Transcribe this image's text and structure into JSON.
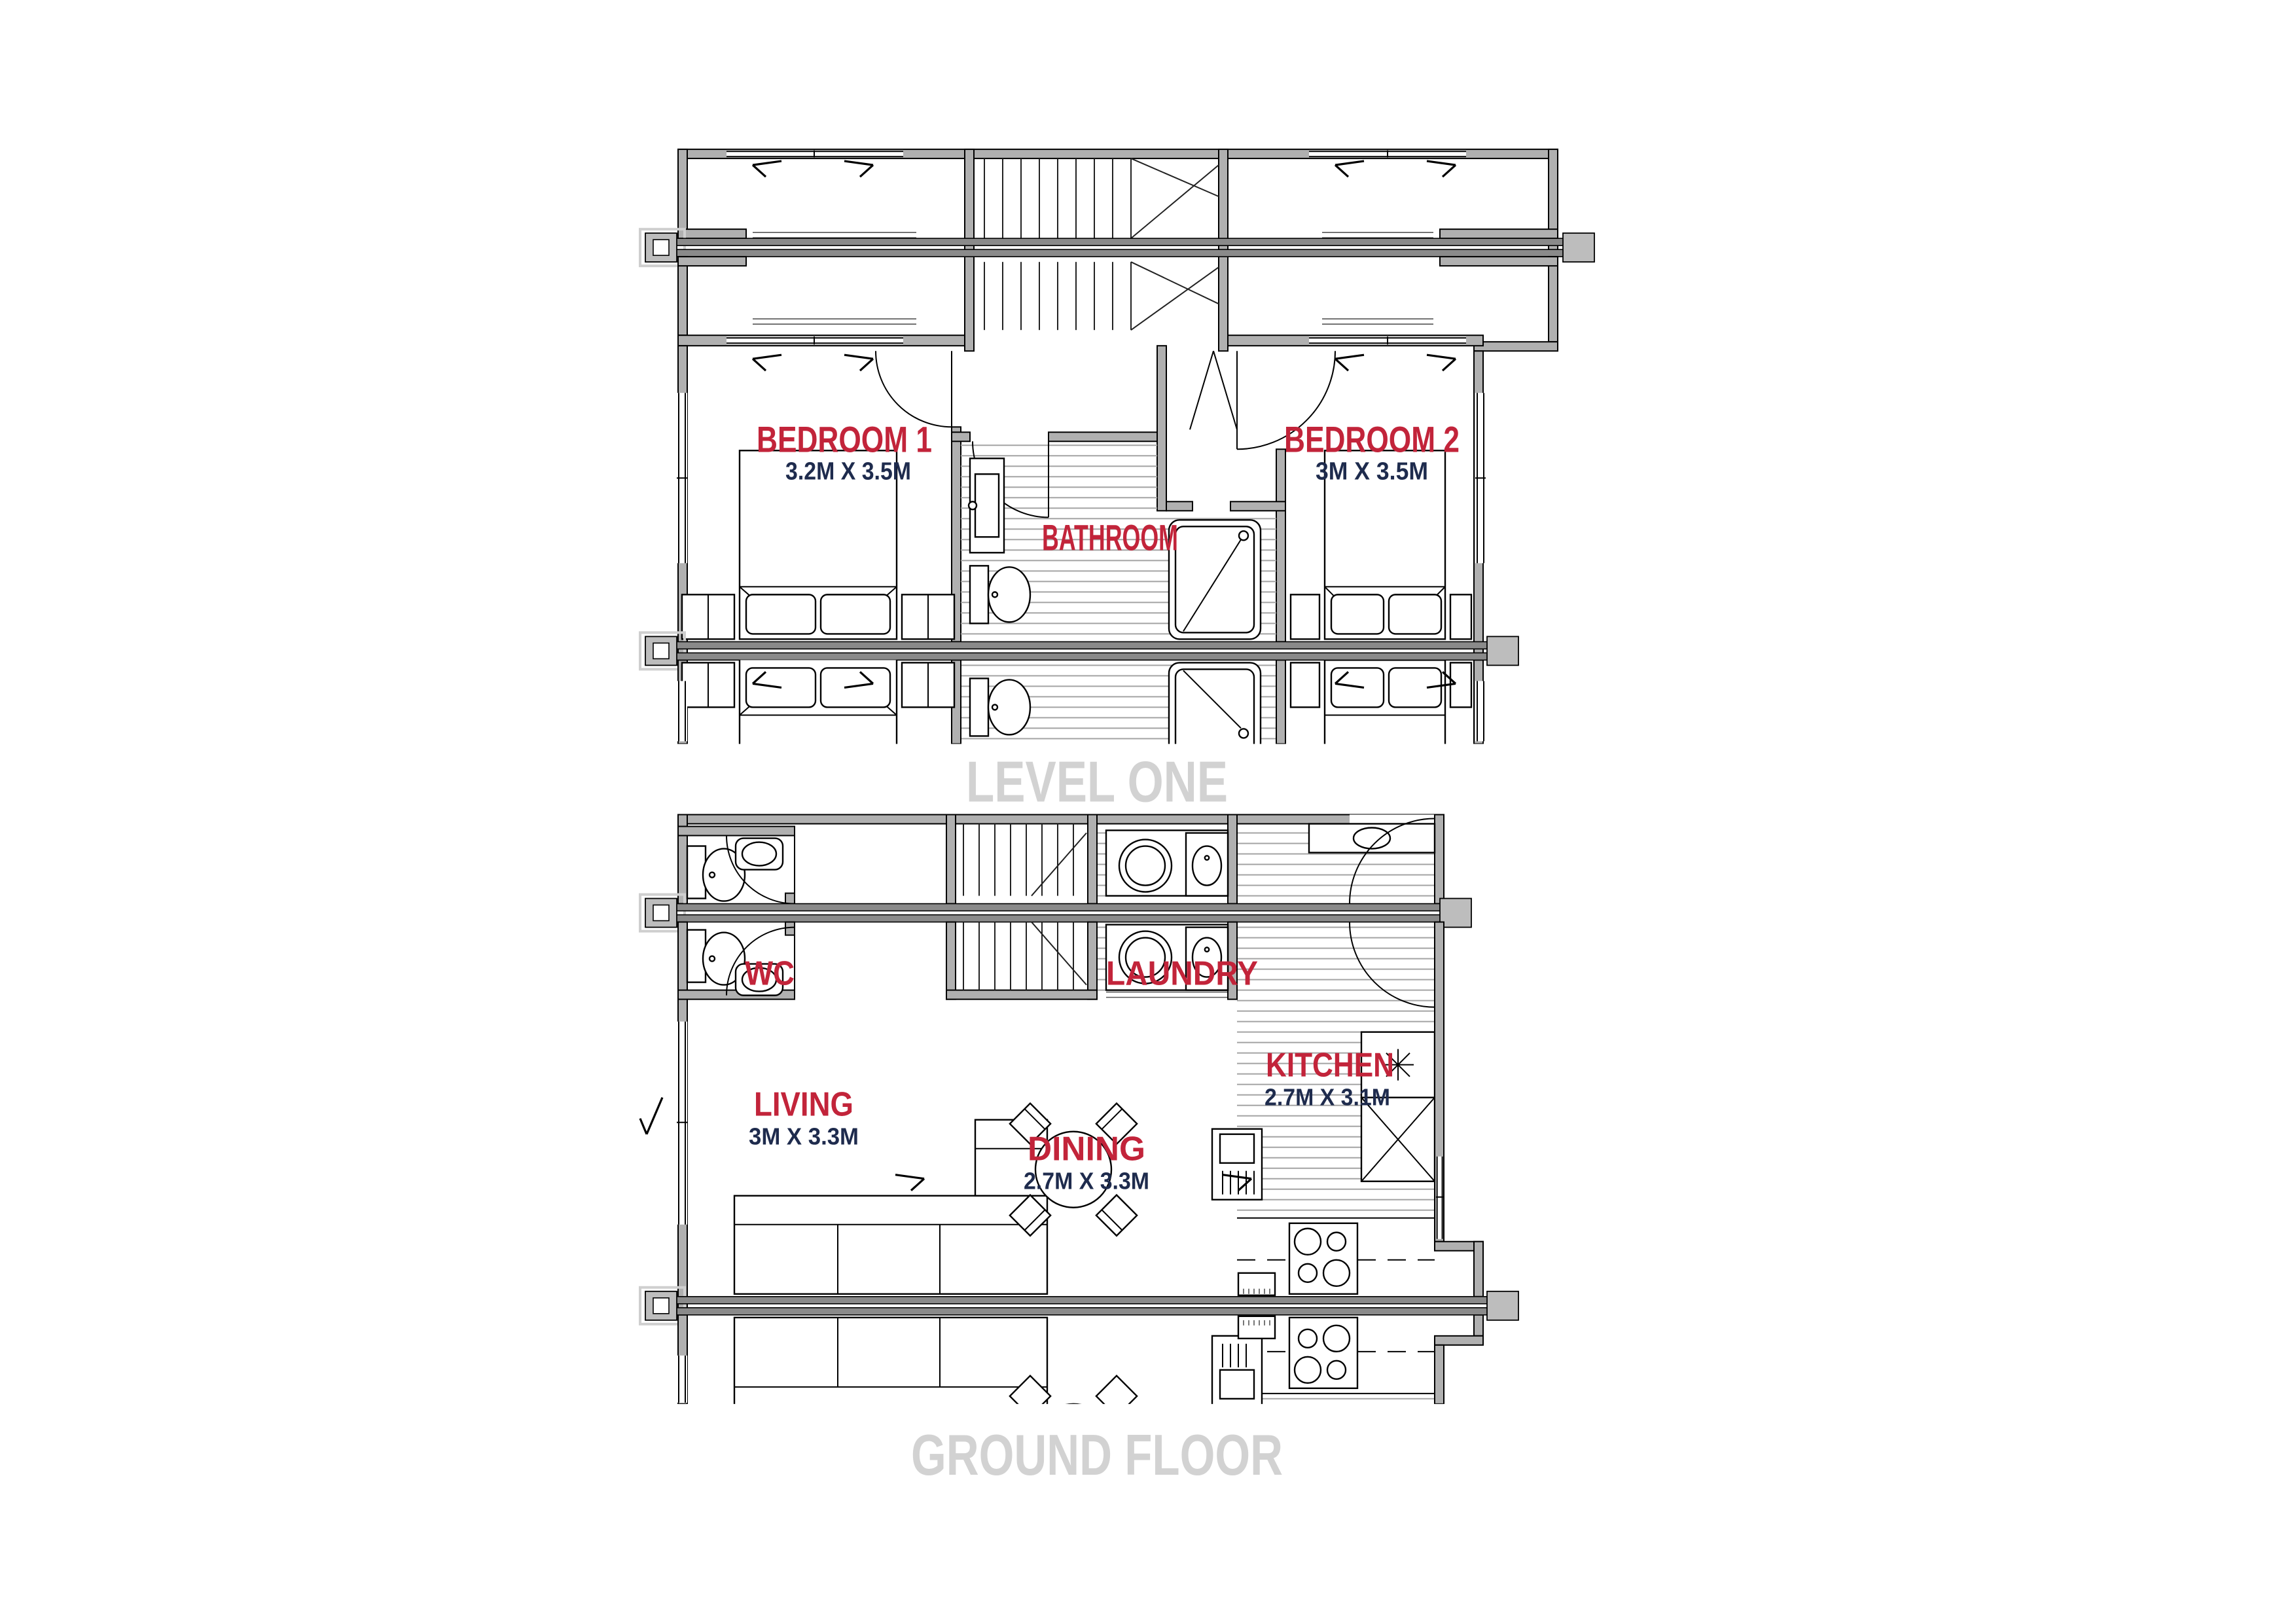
{
  "colors": {
    "label_red": "#C2243A",
    "dims_navy": "#1E2B4D",
    "caption_gray": "#D2D2D2",
    "wall_gray": "#B0B0B0",
    "party_wall_gray": "#8A8A8A"
  },
  "level_one": {
    "caption": "LEVEL ONE",
    "bedroom1": {
      "name": "BEDROOM 1",
      "dims": "3.2M X 3.5M"
    },
    "bathroom": {
      "name": "BATHROOM"
    },
    "bedroom2": {
      "name": "BEDROOM 2",
      "dims": "3M X 3.5M"
    }
  },
  "ground_floor": {
    "caption": "GROUND FLOOR",
    "wc": {
      "name": "WC"
    },
    "laundry": {
      "name": "LAUNDRY"
    },
    "kitchen": {
      "name": "KITCHEN",
      "dims": "2.7M X 3.1M"
    },
    "living": {
      "name": "LIVING",
      "dims": "3M X 3.3M"
    },
    "dining": {
      "name": "DINING",
      "dims": "2.7M X 3.3M"
    }
  }
}
